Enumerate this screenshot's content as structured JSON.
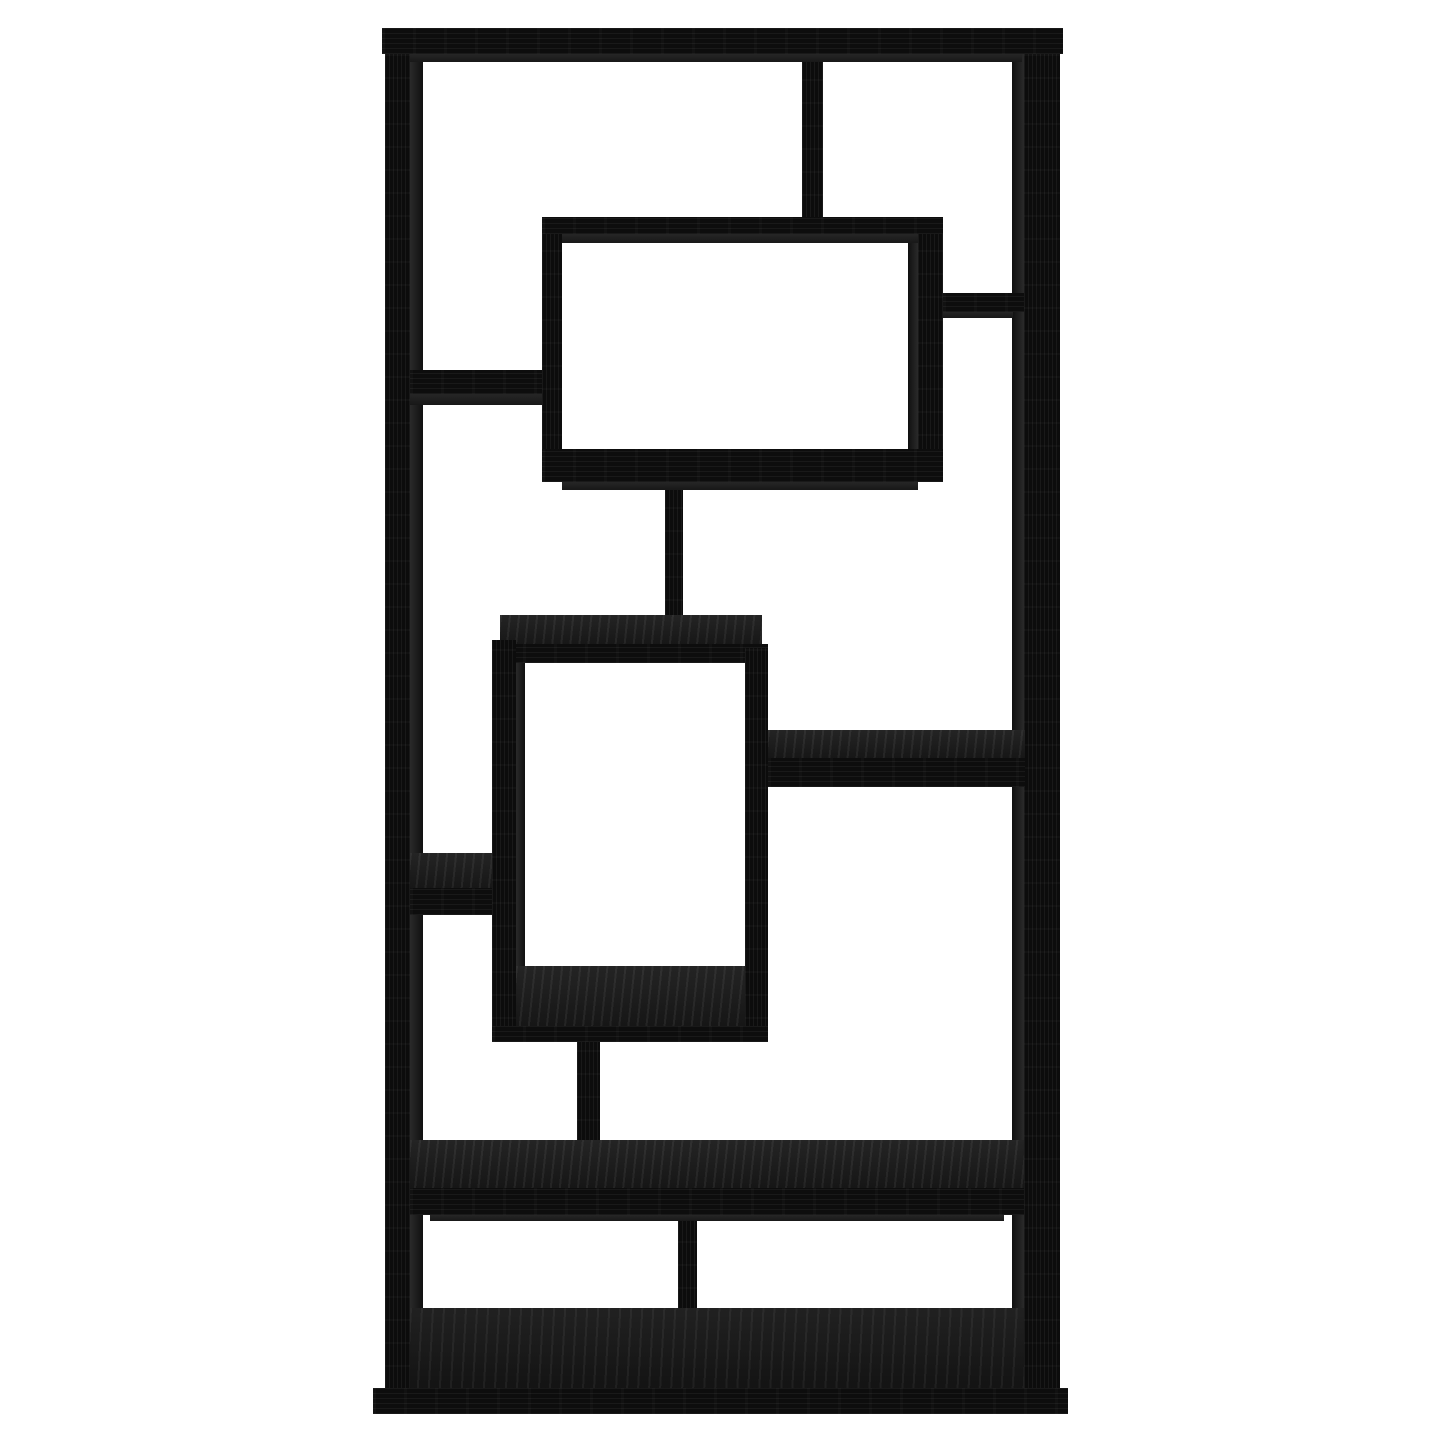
{
  "scene": {
    "description": "Studio product photograph of a tall black wood-grain geometric bookcase (asymmetrical cube etagere) with ten open staggered compartments, centered on a plain white background",
    "background_color": "#ffffff",
    "wood_front_color": "#0c0c0c",
    "wood_surface_color": "#1f1f1f",
    "shadow_color": "#232323",
    "stage_width": 1445,
    "stage_height": 1445
  },
  "parts": [
    {
      "name": "left-post",
      "kind": "black-v",
      "x": 385,
      "y": 28,
      "w": 25,
      "h": 1362
    },
    {
      "name": "left-post-inner-face",
      "kind": "innerface",
      "x": 410,
      "y": 54,
      "w": 13,
      "h": 1254
    },
    {
      "name": "right-post",
      "kind": "black-v",
      "x": 1024,
      "y": 28,
      "w": 36,
      "h": 1362
    },
    {
      "name": "right-post-inner-face",
      "kind": "innerface-l",
      "x": 1012,
      "y": 54,
      "w": 12,
      "h": 1254
    },
    {
      "name": "top-divider",
      "kind": "black-v",
      "x": 802,
      "y": 53,
      "w": 21,
      "h": 166
    },
    {
      "name": "mid-divider",
      "kind": "black-v",
      "x": 665,
      "y": 472,
      "w": 18,
      "h": 152
    },
    {
      "name": "lower-divider",
      "kind": "black-v",
      "x": 577,
      "y": 1038,
      "w": 23,
      "h": 106
    },
    {
      "name": "bottom-divider",
      "kind": "black-v",
      "x": 678,
      "y": 1212,
      "w": 19,
      "h": 100
    },
    {
      "name": "upper-cube-left-panel",
      "kind": "black-v",
      "x": 542,
      "y": 217,
      "w": 20,
      "h": 265
    },
    {
      "name": "upper-cube-right-panel",
      "kind": "black-v",
      "x": 918,
      "y": 217,
      "w": 25,
      "h": 265
    },
    {
      "name": "upper-cube-right-inner",
      "kind": "innerface-l",
      "x": 908,
      "y": 243,
      "w": 10,
      "h": 206
    },
    {
      "name": "upper-cube-top-panel",
      "kind": "black-h",
      "x": 542,
      "y": 217,
      "w": 401,
      "h": 17
    },
    {
      "name": "upper-cube-top-shadow",
      "kind": "shade",
      "x": 562,
      "y": 234,
      "w": 356,
      "h": 9
    },
    {
      "name": "upper-cube-bottom-panel",
      "kind": "black-h",
      "x": 542,
      "y": 449,
      "w": 401,
      "h": 33
    },
    {
      "name": "upper-cube-bottom-shadow",
      "kind": "shade",
      "x": 562,
      "y": 482,
      "w": 356,
      "h": 8
    },
    {
      "name": "upper-left-shelf",
      "kind": "black-h",
      "x": 410,
      "y": 370,
      "w": 132,
      "h": 24
    },
    {
      "name": "upper-left-shelf-shadow",
      "kind": "shade",
      "x": 410,
      "y": 394,
      "w": 132,
      "h": 11
    },
    {
      "name": "upper-right-shelf",
      "kind": "black-h",
      "x": 943,
      "y": 293,
      "w": 81,
      "h": 19
    },
    {
      "name": "upper-right-shelf-shadow",
      "kind": "shade",
      "x": 943,
      "y": 312,
      "w": 70,
      "h": 6
    },
    {
      "name": "center-cube-top-surface",
      "kind": "surface",
      "x": 500,
      "y": 615,
      "w": 262,
      "h": 33
    },
    {
      "name": "center-cube-top-front",
      "kind": "black-h",
      "x": 492,
      "y": 644,
      "w": 276,
      "h": 19
    },
    {
      "name": "center-cube-left-panel",
      "kind": "black-v",
      "x": 492,
      "y": 640,
      "w": 24,
      "h": 402
    },
    {
      "name": "center-cube-left-inner",
      "kind": "innerface",
      "x": 516,
      "y": 663,
      "w": 9,
      "h": 345
    },
    {
      "name": "center-cube-right-panel",
      "kind": "black-v",
      "x": 745,
      "y": 648,
      "w": 23,
      "h": 394
    },
    {
      "name": "center-cube-floor-surface",
      "kind": "surface",
      "x": 516,
      "y": 966,
      "w": 229,
      "h": 64
    },
    {
      "name": "center-cube-bottom-front",
      "kind": "black-h",
      "x": 492,
      "y": 1026,
      "w": 276,
      "h": 16
    },
    {
      "name": "right-mid-shelf-surface",
      "kind": "surface",
      "x": 768,
      "y": 730,
      "w": 257,
      "h": 31
    },
    {
      "name": "right-mid-shelf-front",
      "kind": "black-h",
      "x": 768,
      "y": 758,
      "w": 257,
      "h": 29
    },
    {
      "name": "left-low-shelf-surface",
      "kind": "surface",
      "x": 410,
      "y": 853,
      "w": 82,
      "h": 39
    },
    {
      "name": "left-low-shelf-front",
      "kind": "black-h",
      "x": 410,
      "y": 888,
      "w": 82,
      "h": 27
    },
    {
      "name": "big-shelf-surface",
      "kind": "surface",
      "x": 410,
      "y": 1140,
      "w": 614,
      "h": 51
    },
    {
      "name": "big-shelf-front",
      "kind": "black-h",
      "x": 410,
      "y": 1188,
      "w": 614,
      "h": 27
    },
    {
      "name": "big-shelf-shadow",
      "kind": "shade",
      "x": 430,
      "y": 1215,
      "w": 574,
      "h": 6
    },
    {
      "name": "base-floor-surface",
      "kind": "floorsurface",
      "x": 410,
      "y": 1308,
      "w": 614,
      "h": 82
    },
    {
      "name": "top-bar",
      "kind": "black-h",
      "x": 382,
      "y": 28,
      "w": 681,
      "h": 26
    },
    {
      "name": "top-bar-shadow",
      "kind": "shade",
      "x": 410,
      "y": 54,
      "w": 612,
      "h": 8
    },
    {
      "name": "base-plinth",
      "kind": "black-h",
      "x": 373,
      "y": 1388,
      "w": 695,
      "h": 26
    }
  ]
}
